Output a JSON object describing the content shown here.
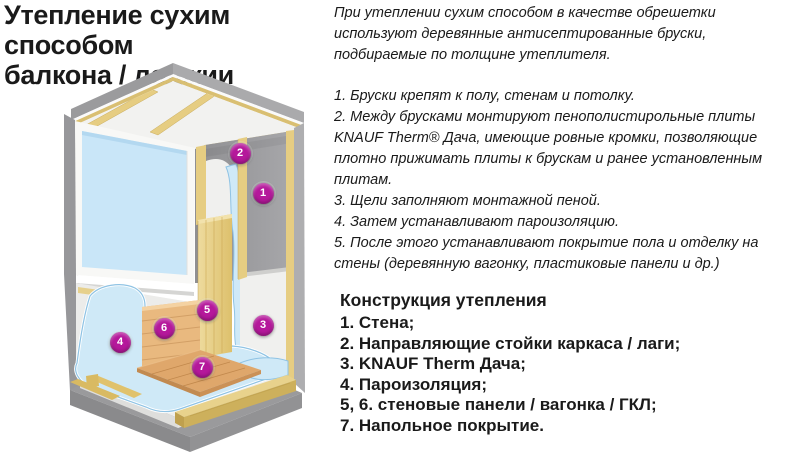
{
  "header": {
    "title_line1": "Утепление сухим способом",
    "title_line2": "балкона / лоджии"
  },
  "article": {
    "intro": "При утеплении сухим способом в качестве обрешетки используют деревянные антисептированные бруски, подбираемые по толщине утеплителя.",
    "steps": [
      "1. Бруски крепят к полу, стенам и потолку.",
      "2. Между брусками монтируют пенополистирольные плиты KNAUF Therm® Дача, имеющие ровные кромки, позволяющие плотно прижимать плиты к брускам и ранее установленным плитам.",
      "3. Щели заполняют монтажной пеной.",
      "4. Затем устанавливают пароизоляцию.",
      "5. После этого устанавливают покрытие пола и отделку на стены (деревянную вагонку, пластиковые панели и др.)"
    ]
  },
  "legend": {
    "heading": "Конструкция утепления",
    "items": [
      "1. Стена;",
      "2. Направляющие стойки каркаса / лаги;",
      "3. KNAUF Therm Дача;",
      "4. Пароизоляция;",
      "5, 6. стеновые панели / вагонка / ГКЛ;",
      "7. Напольное покрытие."
    ]
  },
  "diagram": {
    "markers": [
      {
        "n": "1",
        "x": 263,
        "y": 133
      },
      {
        "n": "2",
        "x": 240,
        "y": 93
      },
      {
        "n": "3",
        "x": 263,
        "y": 265
      },
      {
        "n": "4",
        "x": 120,
        "y": 282
      },
      {
        "n": "5",
        "x": 207,
        "y": 250
      },
      {
        "n": "6",
        "x": 164,
        "y": 268
      },
      {
        "n": "7",
        "x": 202,
        "y": 307
      }
    ],
    "colors": {
      "marker": "#b5189b",
      "window_glass": "#c9e6f8",
      "film": "#cfe9f7",
      "film_edge": "#8fc3e4",
      "wood_batten": "#e6cd82",
      "wood_batten_dark": "#d9bf72",
      "wood_panel": "#e9b97f",
      "wood_floor": "#dfa76b",
      "wall_gray": "#9d9da0",
      "concrete": "#9a9a9c",
      "panel_white": "#f0f0ee"
    }
  }
}
